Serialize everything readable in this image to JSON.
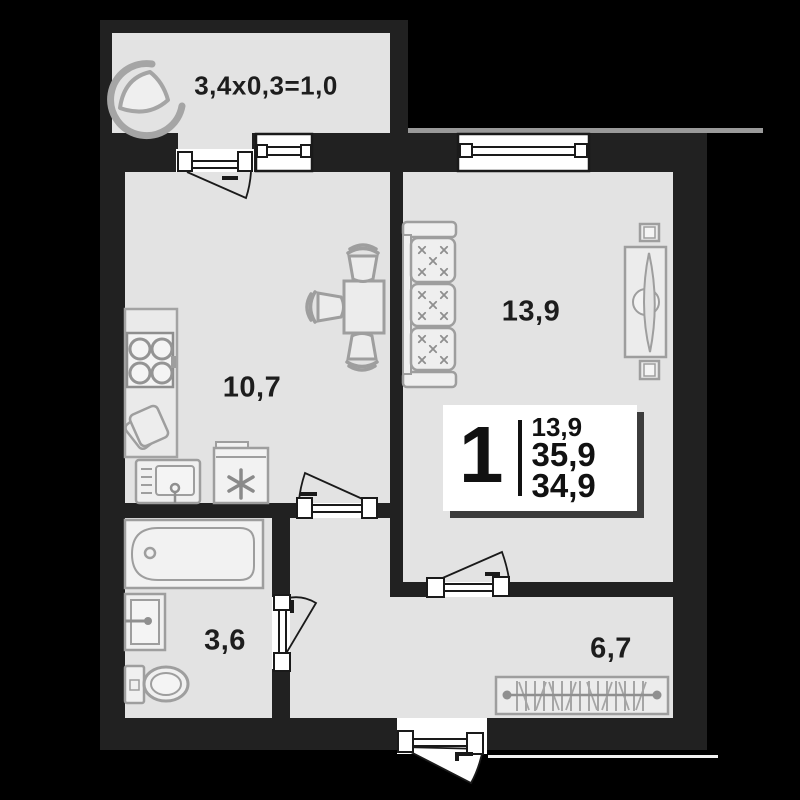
{
  "balcony": {
    "label": "3,4x0,3=1,0"
  },
  "rooms": {
    "kitchen": {
      "area": "10,7"
    },
    "living_room": {
      "area": "13,9"
    },
    "bathroom": {
      "area": "3,6"
    },
    "hallway": {
      "area": "6,7"
    }
  },
  "info_card": {
    "room_count": "1",
    "living_area": "13,9",
    "total_area": "35,9",
    "area_without_balcony": "34,9"
  },
  "icons": {
    "fridge": "snowflake-asterisk",
    "cushions": "x-stitch"
  },
  "colors": {
    "background": "#000000",
    "walls": "#212121",
    "floor": "#e3e3e3",
    "fixtures": "#9e9e9e",
    "text": "#1d1d1d",
    "card_shadow": "#3c3c3c"
  }
}
